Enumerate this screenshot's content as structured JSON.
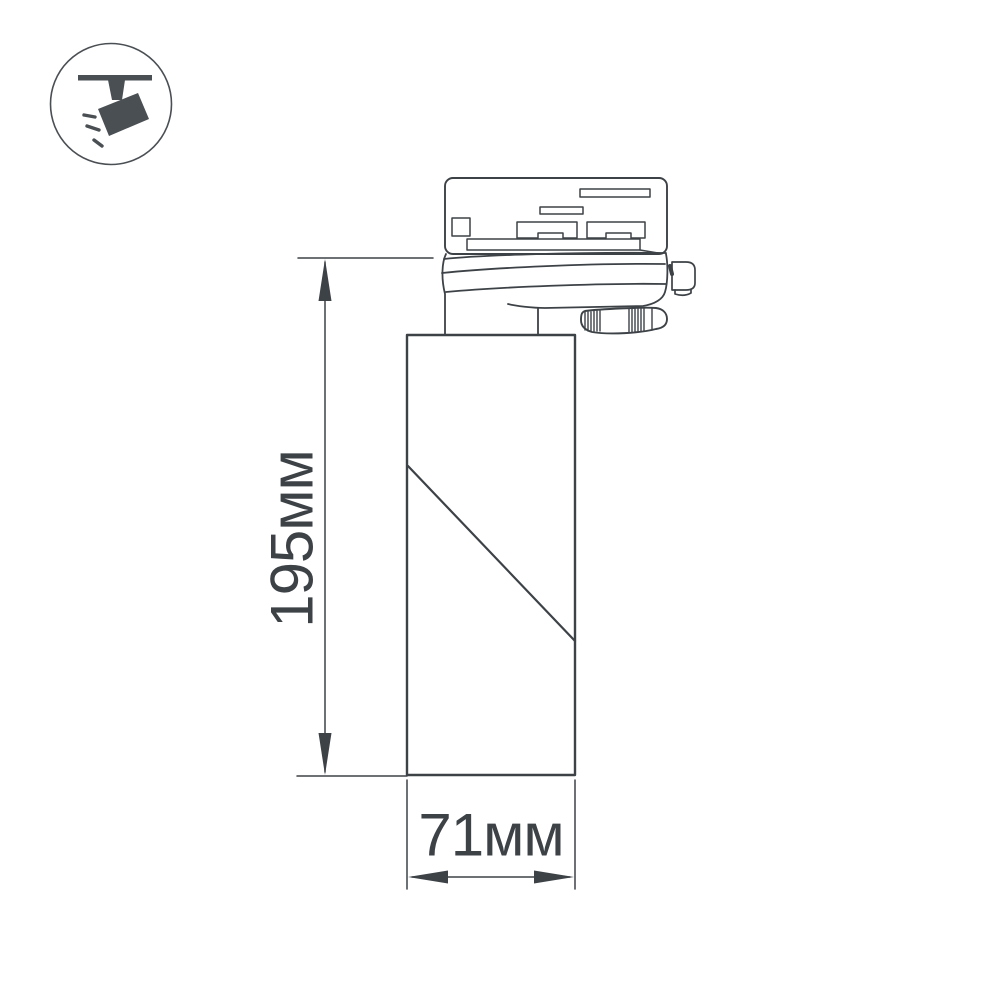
{
  "diagram": {
    "icon": {
      "name": "ceiling-track-spotlight-icon"
    },
    "labels": {
      "height": "195мм",
      "width": "71мм"
    },
    "colors": {
      "line": "#3d4247",
      "text": "#3d4247",
      "icon_fill": "#4a4f54",
      "background": "#ffffff"
    }
  }
}
